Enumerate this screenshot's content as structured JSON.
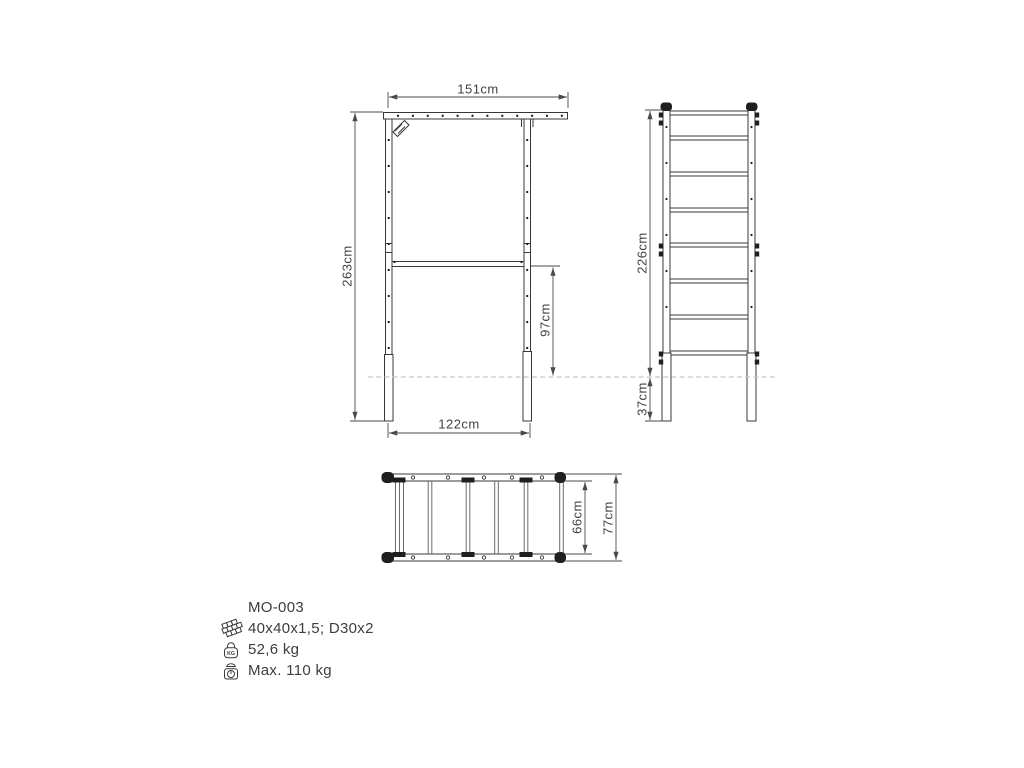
{
  "drawing": {
    "views": {
      "front": {
        "dim_top_width": "151cm",
        "dim_height": "263cm",
        "dim_crossbar_height": "97cm",
        "dim_bottom_width": "122cm"
      },
      "side": {
        "dim_height_above_ground": "226cm",
        "dim_underground_depth": "37cm"
      },
      "top": {
        "dim_inner_depth": "66cm",
        "dim_outer_depth": "77cm"
      }
    },
    "specs": {
      "code": "MO-003",
      "weight_icon_badge": "KG",
      "rows": [
        {
          "icon": "steel-profiles-icon",
          "text": "40x40x1,5; D30x2"
        },
        {
          "icon": "weight-icon",
          "text": "52,6 kg"
        },
        {
          "icon": "max-load-scale-icon",
          "text": "Max. 110 kg"
        }
      ]
    },
    "colors": {
      "line": "#383838",
      "dimension": "#4a4a4a",
      "ground": "#c6c6c6",
      "text": "#3d3d3d",
      "accent_black": "#1f1f1f"
    }
  }
}
